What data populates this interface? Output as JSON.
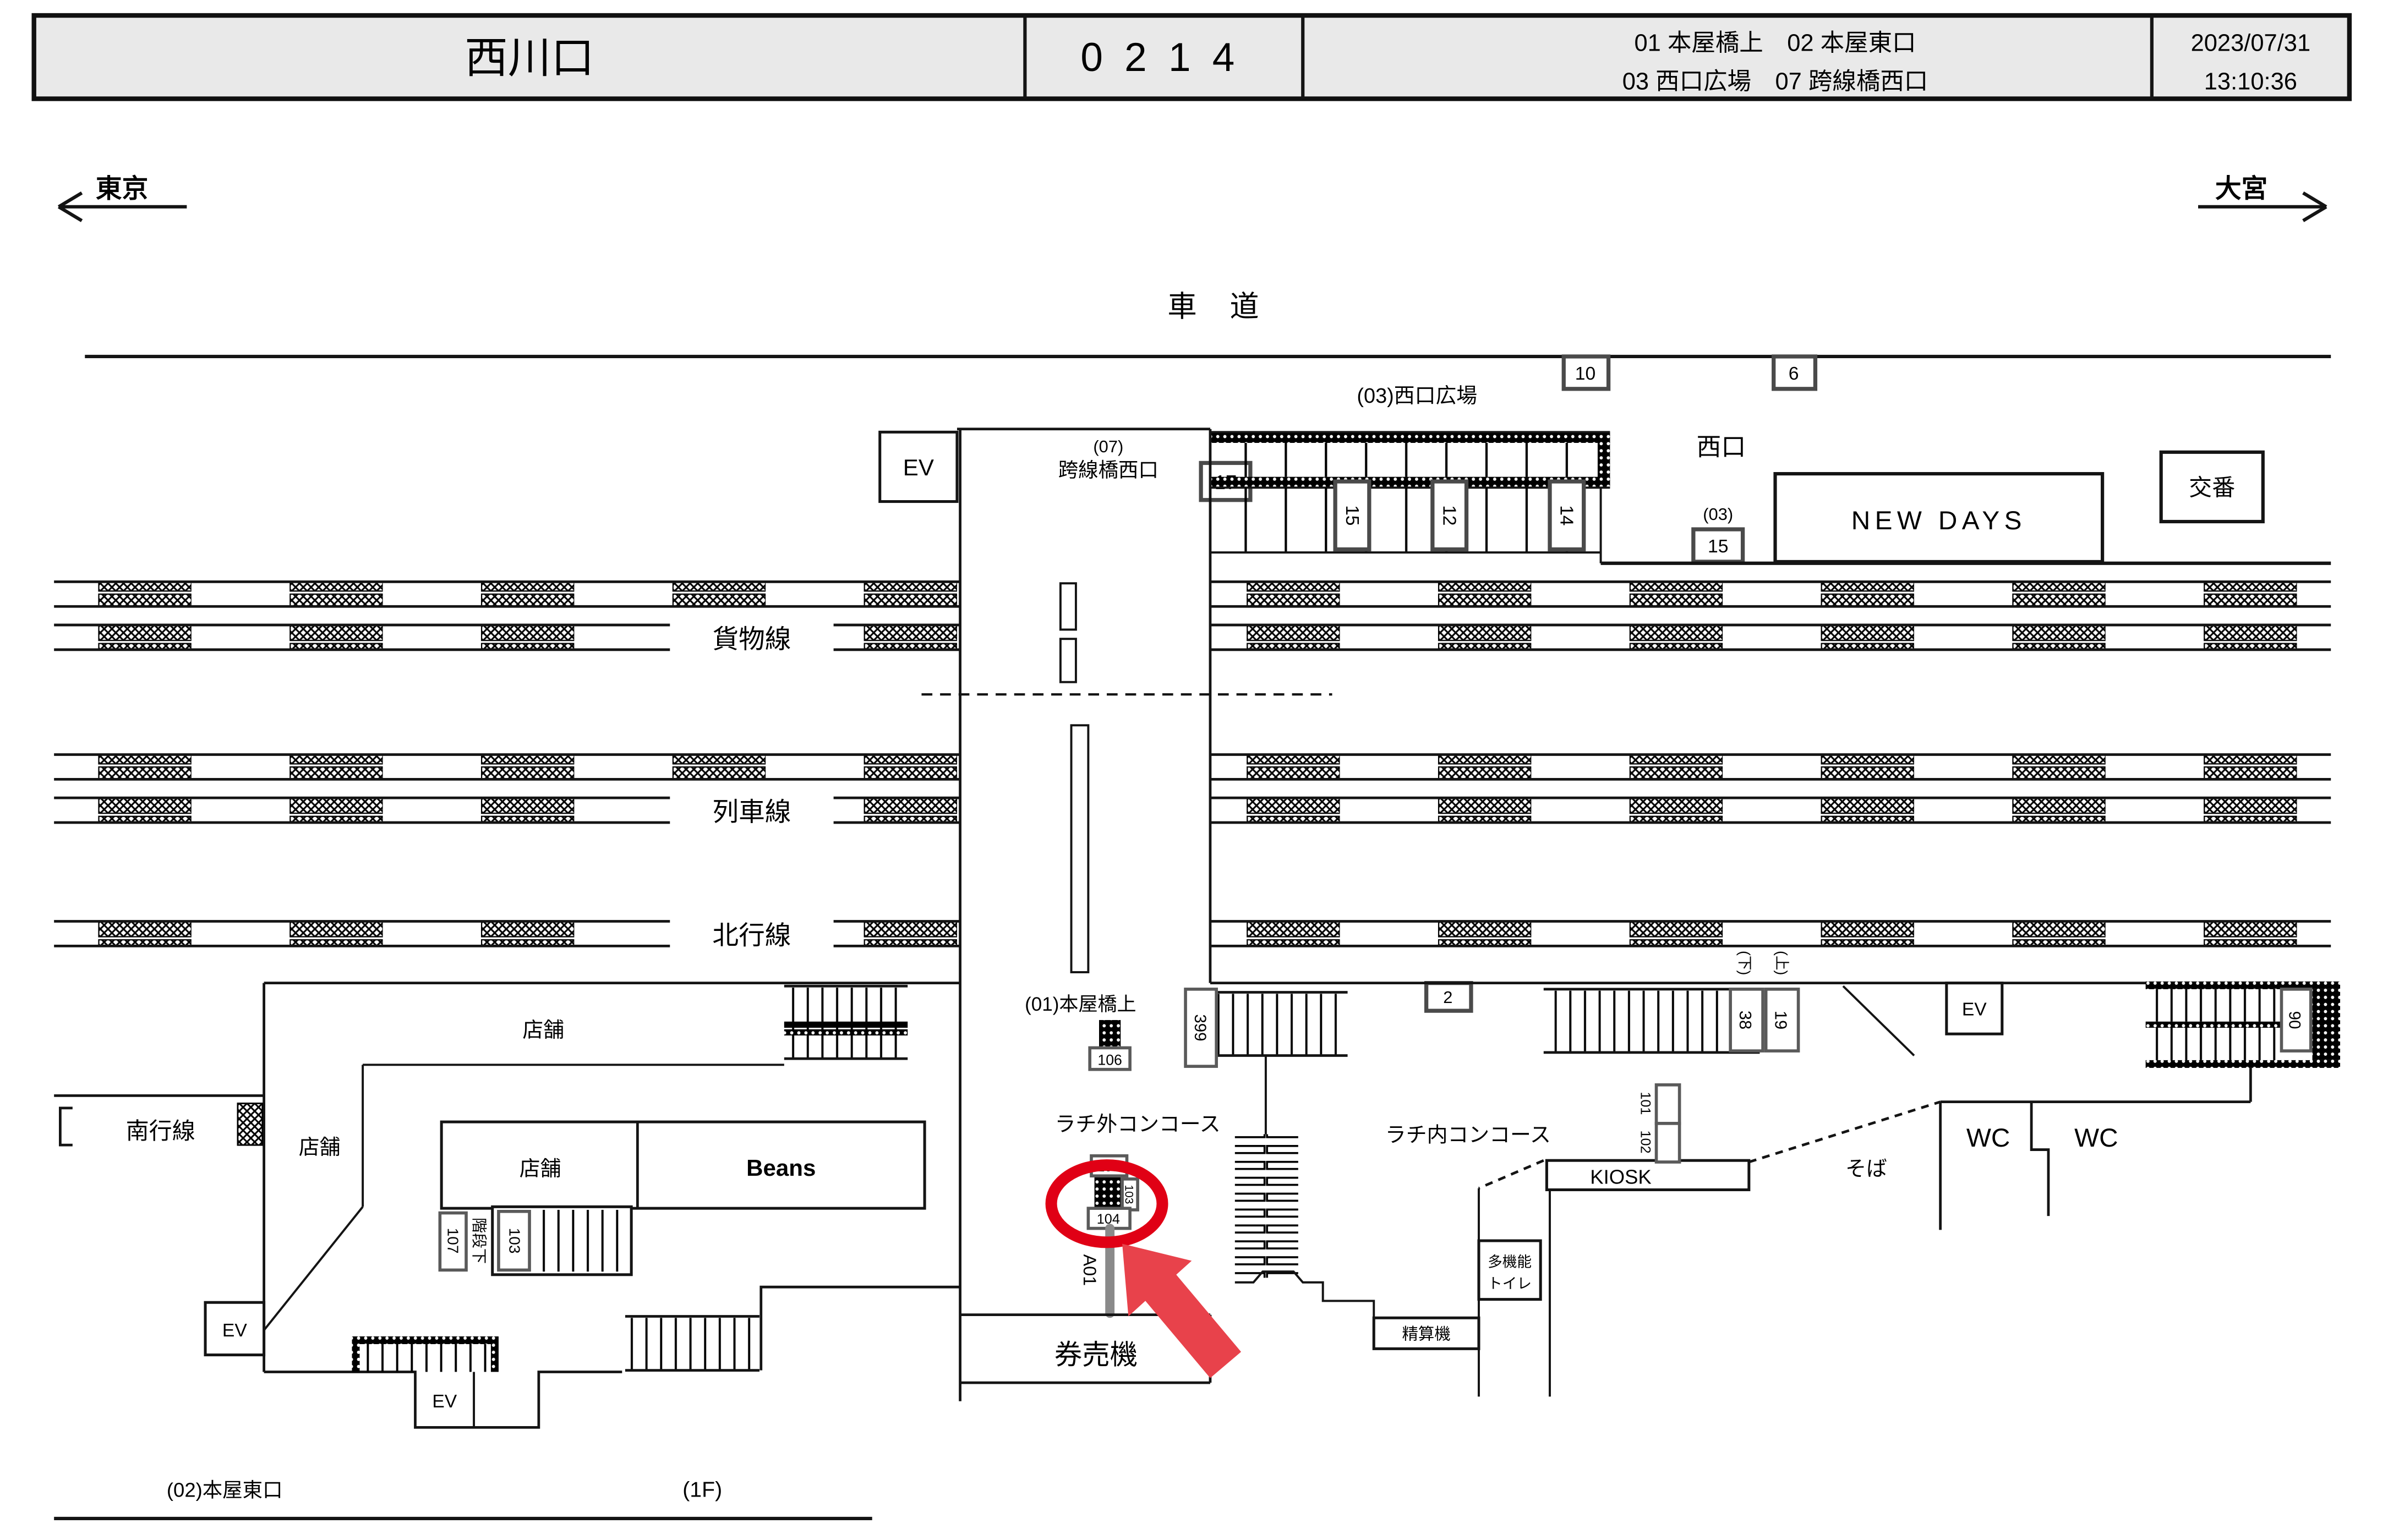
{
  "header": {
    "station": "西川口",
    "code": "0214",
    "cameras_line1": "01 本屋橋上　02 本屋東口",
    "cameras_line2": "03 西口広場　07 跨線橋西口",
    "date": "2023/07/31",
    "time": "13:10:36"
  },
  "directions": {
    "left": "東京",
    "right": "大宮"
  },
  "m": {
    "shado": "車 道",
    "hiroba": "(03)西口広場",
    "n10": "10",
    "n6": "6",
    "ev": "EV",
    "k07": "(07)",
    "kosen": "跨線橋西口",
    "n17": "17",
    "n15": "15",
    "n12": "12",
    "n14": "14",
    "nishiguchi": "西口",
    "p03": "(03)",
    "newdays": "NEW DAYS",
    "koban": "交番",
    "kamotsu": "貨物線",
    "ressha": "列車線",
    "hokko": "北行線",
    "nanko": "南行線",
    "honya1": "(01)本屋橋上",
    "n106": "106",
    "n399": "399",
    "n2": "2",
    "rachigai": "ラチ外コンコース",
    "rachinai": "ラチ内コンコース",
    "n105": "105",
    "n103": "103",
    "n104": "104",
    "a01": "A01",
    "kenbaiki": "券売機",
    "n101": "101",
    "n102": "102",
    "kiosk": "KIOSK",
    "tamo1": "多機能",
    "tamo2": "トイレ",
    "seisanki": "精算機",
    "soba": "そば",
    "wc": "WC",
    "shita": "(下)",
    "ue": "(上)",
    "n38": "38",
    "n19": "19",
    "n90": "90",
    "tenpo": "店舗",
    "beans": "Beans",
    "n107": "107",
    "kaidan": "階段下",
    "honya2": "(02)本屋東口",
    "floor": "(1F)"
  },
  "colors": {
    "circle": "#e00015",
    "arrow": "#e8424b",
    "header_bg": "#e9e9e9"
  }
}
